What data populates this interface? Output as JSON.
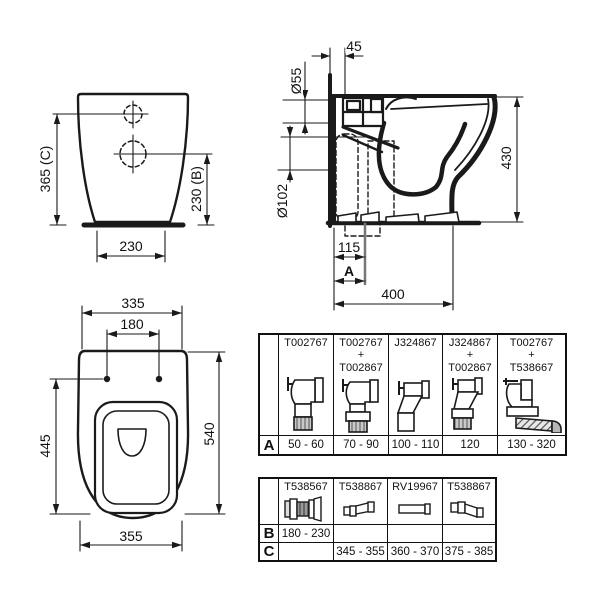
{
  "colors": {
    "ink": "#1a1a1a",
    "rib_gray": "#c9c9c9",
    "cap_gray": "#b5b5b5"
  },
  "views": {
    "front": {
      "height_c": "365 (C)",
      "height_b": "230 (B)",
      "base_width": "230"
    },
    "side": {
      "wall_offset": "45",
      "inlet_d": "Ø55",
      "outlet_d": "Ø102",
      "height": "430",
      "outlet_dist": "115",
      "dim_a": "A",
      "depth": "400"
    },
    "top": {
      "width_lid": "335",
      "hole_spacing": "180",
      "length_bowl": "445",
      "length": "540",
      "width_max": "355"
    }
  },
  "tables": {
    "a": {
      "label": "A",
      "cols": [
        {
          "part": "T002767",
          "icon": "elbow-90",
          "range": "50 - 60"
        },
        {
          "part": "T002767\n+\nT002867",
          "icon": "elbow-90-extension",
          "range": "70 - 90"
        },
        {
          "part": "J324867",
          "icon": "offset-connector",
          "range": "100 - 110"
        },
        {
          "part": "J324867\n+\nT002867",
          "icon": "offset-connector-extension",
          "range": "120"
        },
        {
          "part": "T002767\n+\nT538667",
          "icon": "elbow-flexible-hose",
          "range": "130 - 320"
        }
      ]
    },
    "bc": {
      "label_b": "B",
      "label_c": "C",
      "cols": [
        {
          "part": "T538567",
          "icon": "multi-coupling",
          "range_b": "180 - 230",
          "range_c": ""
        },
        {
          "part": "T538867",
          "icon": "compact-connector",
          "range_b": "",
          "range_c": "345 - 355"
        },
        {
          "part": "RV19967",
          "icon": "straight-pipe",
          "range_b": "",
          "range_c": "360 - 370"
        },
        {
          "part": "T538867",
          "icon": "stepped-connector",
          "range_b": "",
          "range_c": "375 - 385"
        }
      ]
    }
  }
}
